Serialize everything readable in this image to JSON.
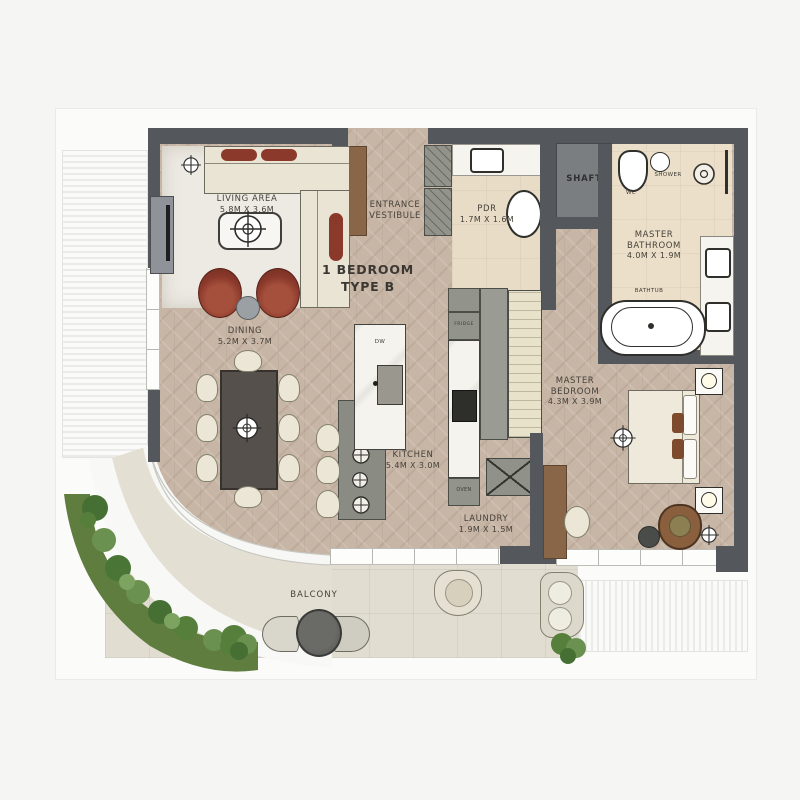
{
  "plan": {
    "title": "1 BEDROOM TYPE B",
    "type": "apartment-floor-plan"
  },
  "rooms": {
    "living": {
      "name": "LIVING AREA",
      "dims": "5.8M X 3.6M"
    },
    "entrance": {
      "name": "ENTRANCE VESTIBULE"
    },
    "pdr": {
      "name": "PDR",
      "dims": "1.7M X 1.6M"
    },
    "shaft": {
      "name": "SHAFT"
    },
    "master_bath": {
      "name": "MASTER BATHROOM",
      "dims": "4.0M X 1.9M"
    },
    "dining": {
      "name": "DINING",
      "dims": "5.2M X 3.7M"
    },
    "kitchen": {
      "name": "KITCHEN",
      "dims": "5.4M X 3.0M"
    },
    "master_bed": {
      "name": "MASTER BEDROOM",
      "dims": "4.3M X 3.9M"
    },
    "laundry": {
      "name": "LAUNDRY",
      "dims": "1.9M X 1.5M"
    },
    "balcony": {
      "name": "BALCONY"
    }
  },
  "labels": {
    "fridge": "FRIDGE",
    "oven": "OVEN",
    "dw": "DW",
    "wc": "WC",
    "shower": "SHOWER",
    "bathtub": "BATHTUB"
  },
  "colors": {
    "wall": "#54585c",
    "wood_floor": "#c7b5a5",
    "bath_floor": "#e8dcc6",
    "balcony_floor": "#e2ddd1",
    "accent_chair_red": "#8b392b",
    "wood_furniture_brown": "#8a6648",
    "garden_green": "#5f7d3e",
    "cream_furniture": "#ebe6d6"
  }
}
